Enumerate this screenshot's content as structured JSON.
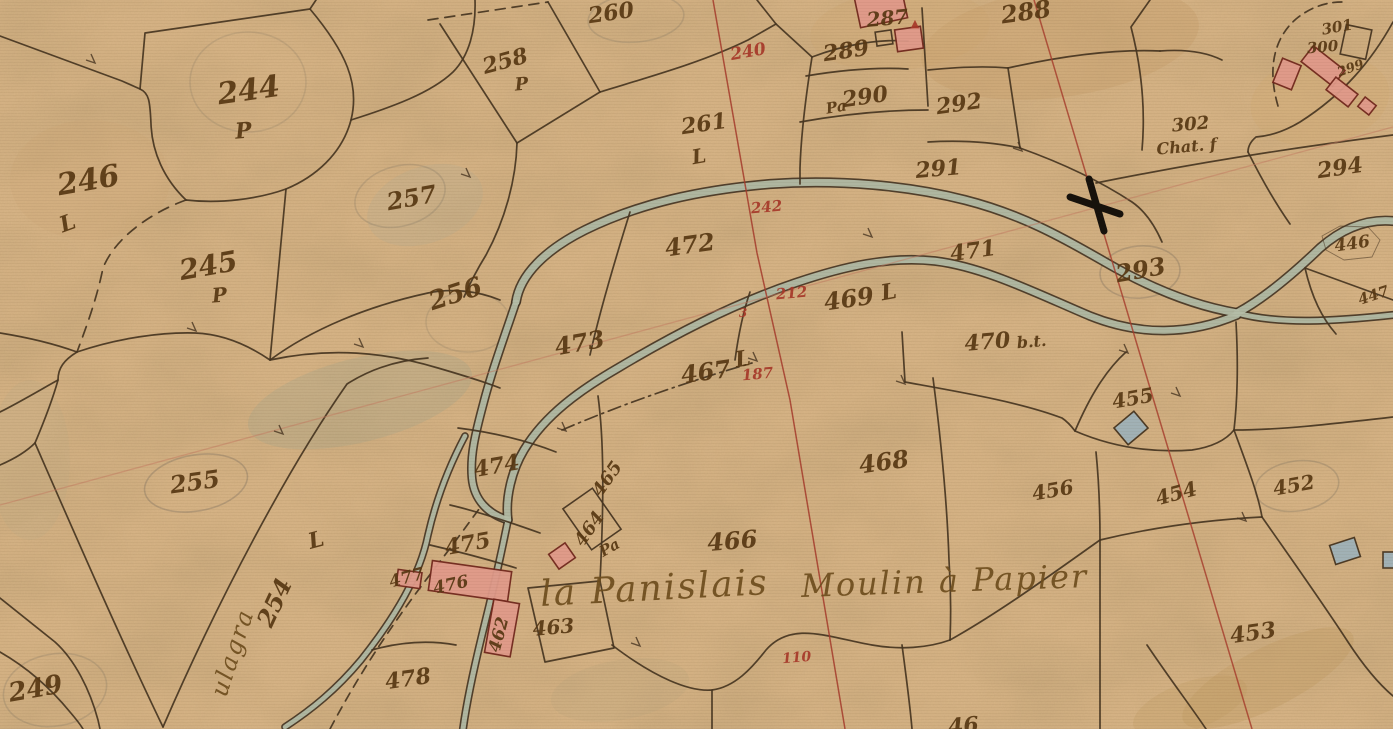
{
  "map": {
    "kind": "cadastral-map-scan",
    "colors": {
      "paper": "#d6b385",
      "ink": "#583813",
      "red": "#a8392a",
      "title": "#6f4e1e",
      "line": "#473521",
      "water": "#b4bda6",
      "bank": "#3f3020",
      "hab_fill": "#e09a8a",
      "hab_stroke": "#73291e",
      "ann_fill": "#9fb2b8",
      "pencil": "#6f675a"
    },
    "labels": [
      {
        "t": "244",
        "x": 250,
        "y": 100,
        "r": -8,
        "s": 30
      },
      {
        "t": "P",
        "x": 244,
        "y": 138,
        "r": -5,
        "s": 22
      },
      {
        "t": "246",
        "x": 90,
        "y": 190,
        "r": -10,
        "s": 30
      },
      {
        "t": "L",
        "x": 70,
        "y": 230,
        "r": -20,
        "s": 22
      },
      {
        "t": "245",
        "x": 210,
        "y": 275,
        "r": -10,
        "s": 28
      },
      {
        "t": "P",
        "x": 220,
        "y": 302,
        "r": -5,
        "s": 20
      },
      {
        "t": "257",
        "x": 413,
        "y": 206,
        "r": -10,
        "s": 24
      },
      {
        "t": "256",
        "x": 458,
        "y": 302,
        "r": -18,
        "s": 26
      },
      {
        "t": "258",
        "x": 507,
        "y": 68,
        "r": -15,
        "s": 22
      },
      {
        "t": "P",
        "x": 522,
        "y": 90,
        "r": -5,
        "s": 18
      },
      {
        "t": "260",
        "x": 612,
        "y": 20,
        "r": -8,
        "s": 22
      },
      {
        "t": "261",
        "x": 705,
        "y": 131,
        "r": -8,
        "s": 22
      },
      {
        "t": "L",
        "x": 700,
        "y": 163,
        "r": -10,
        "s": 20
      },
      {
        "t": "255",
        "x": 196,
        "y": 490,
        "r": -8,
        "s": 24
      },
      {
        "t": "254",
        "x": 282,
        "y": 606,
        "r": -65,
        "s": 24
      },
      {
        "t": "L",
        "x": 318,
        "y": 547,
        "r": -15,
        "s": 22
      },
      {
        "t": "249",
        "x": 37,
        "y": 697,
        "r": -10,
        "s": 26
      },
      {
        "t": "473",
        "x": 581,
        "y": 351,
        "r": -10,
        "s": 24
      },
      {
        "t": "472",
        "x": 691,
        "y": 253,
        "r": -8,
        "s": 24
      },
      {
        "t": "471",
        "x": 974,
        "y": 258,
        "r": -8,
        "s": 22
      },
      {
        "t": "469",
        "x": 850,
        "y": 307,
        "r": -8,
        "s": 24
      },
      {
        "t": "L",
        "x": 890,
        "y": 299,
        "r": -10,
        "s": 22
      },
      {
        "t": "467",
        "x": 707,
        "y": 380,
        "r": -8,
        "s": 24
      },
      {
        "t": "L",
        "x": 744,
        "y": 366,
        "r": -10,
        "s": 22
      },
      {
        "t": "470",
        "x": 988,
        "y": 349,
        "r": -5,
        "s": 22
      },
      {
        "t": "b.t.",
        "x": 1032,
        "y": 347,
        "r": -5,
        "s": 16
      },
      {
        "t": "468",
        "x": 885,
        "y": 470,
        "r": -8,
        "s": 24
      },
      {
        "t": "466",
        "x": 733,
        "y": 549,
        "r": -5,
        "s": 24
      },
      {
        "t": "474",
        "x": 498,
        "y": 473,
        "r": -10,
        "s": 22
      },
      {
        "t": "475",
        "x": 469,
        "y": 551,
        "r": -10,
        "s": 22
      },
      {
        "t": "477",
        "x": 408,
        "y": 583,
        "r": -15,
        "s": 17
      },
      {
        "t": "476",
        "x": 452,
        "y": 590,
        "r": -12,
        "s": 17
      },
      {
        "t": "465",
        "x": 612,
        "y": 482,
        "r": -55,
        "s": 18
      },
      {
        "t": "464",
        "x": 594,
        "y": 532,
        "r": -55,
        "s": 18
      },
      {
        "t": "Pa",
        "x": 612,
        "y": 552,
        "r": -30,
        "s": 15
      },
      {
        "t": "462",
        "x": 504,
        "y": 636,
        "r": -75,
        "s": 17
      },
      {
        "t": "463",
        "x": 554,
        "y": 634,
        "r": -5,
        "s": 20
      },
      {
        "t": "478",
        "x": 409,
        "y": 686,
        "r": -8,
        "s": 22
      },
      {
        "t": "288",
        "x": 1027,
        "y": 20,
        "r": -8,
        "s": 24
      },
      {
        "t": "287",
        "x": 888,
        "y": 25,
        "r": -5,
        "s": 20
      },
      {
        "t": "▲",
        "x": 915,
        "y": 27,
        "r": 0,
        "s": 11,
        "c": "red"
      },
      {
        "t": "289",
        "x": 847,
        "y": 58,
        "r": -8,
        "s": 22
      },
      {
        "t": "Pa",
        "x": 837,
        "y": 112,
        "r": -10,
        "s": 15
      },
      {
        "t": "290",
        "x": 866,
        "y": 104,
        "r": -8,
        "s": 22
      },
      {
        "t": "292",
        "x": 960,
        "y": 111,
        "r": -8,
        "s": 22
      },
      {
        "t": "291",
        "x": 939,
        "y": 176,
        "r": -5,
        "s": 22
      },
      {
        "t": "302",
        "x": 1191,
        "y": 130,
        "r": -5,
        "s": 18
      },
      {
        "t": "Chat. f",
        "x": 1187,
        "y": 152,
        "r": -5,
        "s": 16
      },
      {
        "t": "294",
        "x": 1341,
        "y": 175,
        "r": -8,
        "s": 22
      },
      {
        "t": "301",
        "x": 1338,
        "y": 32,
        "r": -10,
        "s": 15
      },
      {
        "t": "300",
        "x": 1323,
        "y": 52,
        "r": -5,
        "s": 15
      },
      {
        "t": "299",
        "x": 1352,
        "y": 72,
        "r": -20,
        "s": 13
      },
      {
        "t": "293",
        "x": 1142,
        "y": 278,
        "r": -10,
        "s": 24
      },
      {
        "t": "446",
        "x": 1353,
        "y": 249,
        "r": -8,
        "s": 17
      },
      {
        "t": "447",
        "x": 1375,
        "y": 300,
        "r": -18,
        "s": 15
      },
      {
        "t": "455",
        "x": 1134,
        "y": 405,
        "r": -10,
        "s": 20
      },
      {
        "t": "456",
        "x": 1054,
        "y": 497,
        "r": -10,
        "s": 20
      },
      {
        "t": "454",
        "x": 1178,
        "y": 500,
        "r": -15,
        "s": 20
      },
      {
        "t": "452",
        "x": 1295,
        "y": 492,
        "r": -10,
        "s": 20
      },
      {
        "t": "453",
        "x": 1254,
        "y": 640,
        "r": -8,
        "s": 22
      },
      {
        "t": "46",
        "x": 964,
        "y": 733,
        "r": -5,
        "s": 22
      },
      {
        "t": "240",
        "x": 749,
        "y": 57,
        "r": -10,
        "s": 17,
        "c": "red"
      },
      {
        "t": "242",
        "x": 767,
        "y": 212,
        "r": -5,
        "s": 15,
        "c": "red"
      },
      {
        "t": "212",
        "x": 792,
        "y": 298,
        "r": -5,
        "s": 15,
        "c": "red"
      },
      {
        "t": "3",
        "x": 743,
        "y": 317,
        "r": 0,
        "s": 12,
        "c": "red"
      },
      {
        "t": "187",
        "x": 758,
        "y": 379,
        "r": -5,
        "s": 15,
        "c": "red"
      },
      {
        "t": "110",
        "x": 797,
        "y": 662,
        "r": -5,
        "s": 14,
        "c": "red"
      },
      {
        "t": "la Panislais",
        "x": 655,
        "y": 600,
        "r": -3,
        "s": 36,
        "c": "title"
      },
      {
        "t": "Moulin à Papier",
        "x": 945,
        "y": 592,
        "r": -2,
        "s": 32,
        "c": "title"
      },
      {
        "t": "ulagra",
        "x": 240,
        "y": 655,
        "r": -72,
        "s": 24,
        "c": "title"
      }
    ],
    "river": {
      "channels": [
        {
          "d": "M516,302 C520,275 545,250 585,230 C640,203 700,190 770,184 C840,179 910,186 965,200 C1020,214 1060,236 1105,262 C1150,288 1195,306 1237,313",
          "w": 7
        },
        {
          "d": "M508,520 C505,498 512,470 524,450 C545,415 580,390 618,368 C670,337 730,305 795,283 C845,266 890,256 935,261 C985,267 1040,295 1090,316 C1140,336 1190,335 1237,315",
          "w": 6.5
        },
        {
          "d": "M1237,313 C1265,298 1295,272 1320,248 C1345,226 1370,219 1393,221",
          "w": 7
        },
        {
          "d": "M1237,313 C1280,325 1336,321 1393,315",
          "w": 5
        },
        {
          "d": "M516,302 C505,335 492,370 483,405 C475,435 470,456 472,478 C474,500 488,514 508,520",
          "w": 6
        },
        {
          "d": "M508,520 C501,555 492,595 482,635 C474,668 467,700 463,729",
          "w": 5
        },
        {
          "d": "M465,436 C448,468 436,500 428,535 C420,575 396,616 361,660 C336,690 311,710 285,727",
          "w": 4.5
        }
      ]
    },
    "boundaries": [
      {
        "d": "M0,36 L122,81 L140,89"
      },
      {
        "d": "M140,89 L145,33 L310,9 L316,0"
      },
      {
        "d": "M310,9 C346,52 360,84 351,120 C342,154 315,177 286,189 C258,199 220,204 186,200"
      },
      {
        "d": "M186,200 C164,179 152,152 151,124 C150,101 149,93 140,89"
      },
      {
        "d": "M351,120 C392,107 431,93 453,72 C469,56 476,30 475,0"
      },
      {
        "d": "M286,189 C281,248 275,306 270,360"
      },
      {
        "d": "M270,360 C312,329 368,306 428,293 C452,288 478,291 500,300"
      },
      {
        "d": "M0,333 C25,337 52,343 77,352"
      },
      {
        "d": "M77,352 C118,338 162,332 195,333 C223,334 248,345 270,360"
      },
      {
        "d": "M77,352 C64,360 58,368 58,380 C52,402 43,424 35,443"
      },
      {
        "d": "M0,412 C20,402 40,390 58,380"
      },
      {
        "d": "M35,443 C70,523 120,638 163,727"
      },
      {
        "d": "M163,727 C218,600 288,468 347,384 C372,368 400,360 428,358"
      },
      {
        "d": "M0,465 C14,459 26,452 35,443"
      },
      {
        "d": "M0,598 L55,642 C75,660 90,690 98,720 L100,729"
      },
      {
        "d": "M0,652 C28,668 52,690 70,712 C76,719 80,724 83,729"
      },
      {
        "d": "M270,360 C330,347 385,352 438,368 C462,375 482,381 500,388"
      },
      {
        "d": "M428,20 L548,2",
        "dash": "10 7"
      },
      {
        "d": "M548,2 L600,92"
      },
      {
        "d": "M600,92 L517,143"
      },
      {
        "d": "M517,143 L440,24"
      },
      {
        "d": "M517,143 C516,180 505,220 486,255 C478,268 470,283 464,297"
      },
      {
        "d": "M600,92 C652,76 703,62 748,40 L776,24"
      },
      {
        "d": "M757,0 L776,24"
      },
      {
        "d": "M776,24 L812,57 C806,95 801,135 800,168 L800,184"
      },
      {
        "d": "M812,57 C846,44 880,39 908,41"
      },
      {
        "d": "M806,76 C842,70 876,67 908,69"
      },
      {
        "d": "M922,8 L928,106"
      },
      {
        "d": "M800,122 C845,114 890,110 928,110"
      },
      {
        "d": "M928,70 C958,67 986,66 1008,68"
      },
      {
        "d": "M1008,68 C1062,56 1115,49 1160,51"
      },
      {
        "d": "M1008,68 L1020,148"
      },
      {
        "d": "M928,142 C962,140 992,142 1020,148"
      },
      {
        "d": "M1020,148 C1062,163 1100,181 1132,202 C1145,211 1155,226 1162,242"
      },
      {
        "d": "M1160,51 C1186,49 1206,52 1222,60"
      },
      {
        "d": "M1150,0 L1131,27 C1140,62 1146,105 1142,150"
      },
      {
        "d": "M1096,183 C1190,164 1290,148 1393,135"
      },
      {
        "d": "M1393,22 C1372,60 1344,94 1300,122 C1285,131 1270,136 1256,137 C1250,142 1248,147 1248,152"
      },
      {
        "d": "M1248,152 C1262,180 1276,204 1290,224"
      },
      {
        "d": "M1278,106 C1268,72 1272,40 1296,19 C1312,6 1328,2 1342,2",
        "dash": "9 6"
      },
      {
        "d": "M630,212 C615,260 600,310 590,355"
      },
      {
        "d": "M750,292 C742,315 738,338 735,360"
      },
      {
        "d": "M562,430 C625,403 690,381 752,363",
        "dash": "13 5 2 5"
      },
      {
        "d": "M933,378 C941,440 947,500 949,560 C951,590 951,616 950,640"
      },
      {
        "d": "M902,332 C903,350 904,366 905,382"
      },
      {
        "d": "M905,382 C960,392 1020,402 1062,418 C1068,422 1072,427 1075,431"
      },
      {
        "d": "M1075,431 C1090,396 1106,370 1126,352"
      },
      {
        "d": "M1075,431 C1112,447 1152,453 1192,450 C1212,447 1226,440 1234,430"
      },
      {
        "d": "M1234,430 C1238,395 1238,358 1236,322"
      },
      {
        "d": "M1234,430 C1248,468 1258,494 1262,517"
      },
      {
        "d": "M1100,540 C1150,528 1205,520 1262,517"
      },
      {
        "d": "M1262,517 C1292,560 1322,602 1348,642 C1365,668 1380,685 1393,696"
      },
      {
        "d": "M1096,452 C1099,482 1100,510 1100,540"
      },
      {
        "d": "M1100,540 C1100,604 1100,668 1100,729"
      },
      {
        "d": "M950,640 C1000,612 1052,574 1100,540"
      },
      {
        "d": "M612,645 C655,678 690,692 712,690 C735,687 752,668 766,650 C792,620 830,638 872,645 C900,650 928,648 950,640"
      },
      {
        "d": "M712,690 L712,729"
      },
      {
        "d": "M902,645 C906,675 910,705 912,729"
      },
      {
        "d": "M528,588 L600,581 L614,648 L545,662 Z"
      },
      {
        "d": "M372,650 C400,642 428,640 456,645"
      },
      {
        "d": "M598,396 C604,440 604,500 600,581"
      },
      {
        "d": "M450,505 C480,512 512,523 540,533"
      },
      {
        "d": "M430,545 C460,552 490,560 516,568"
      },
      {
        "d": "M1305,268 L1393,300"
      },
      {
        "d": "M1305,268 C1312,298 1322,318 1336,334"
      },
      {
        "d": "M1234,430 C1280,430 1332,424 1393,417"
      },
      {
        "d": "M1147,645 C1172,682 1192,708 1206,729"
      },
      {
        "d": "M186,200 C150,213 115,238 103,268 C97,298 86,328 77,352",
        "dash": "11 8"
      },
      {
        "d": "M330,729 C360,672 395,620 432,572 C452,546 468,524 482,505",
        "dash": "9 7"
      },
      {
        "d": "M458,428 C490,432 525,440 556,452"
      },
      {
        "d": "M1322,236 L1340,226 L1368,227 L1380,240 L1372,257 L1344,260 L1326,250 Z",
        "w": 0.9,
        "op": 0.55
      }
    ],
    "survey_lines": [
      {
        "d": "M713,0 L757,253 L790,400 L845,729",
        "color": "#a63b2b",
        "w": 1.5,
        "op": 0.85
      },
      {
        "d": "M0,505 L1393,127",
        "color": "#c47a60",
        "w": 1.3,
        "op": 0.5
      },
      {
        "d": "M1034,0 L1252,729",
        "color": "#a63b2b",
        "w": 1.5,
        "op": 0.8
      }
    ],
    "benchmark_cross": {
      "x": 1095,
      "y": 205
    },
    "buildings": [
      [
        881,
        8,
        48,
        30,
        -12,
        "hab"
      ],
      [
        909,
        39,
        26,
        22,
        -8,
        "hab"
      ],
      [
        884,
        38,
        16,
        14,
        -8,
        "out"
      ],
      [
        1287,
        74,
        20,
        26,
        22,
        "hab"
      ],
      [
        1323,
        66,
        40,
        20,
        38,
        "hab"
      ],
      [
        1342,
        92,
        28,
        16,
        38,
        "hab"
      ],
      [
        1356,
        42,
        26,
        30,
        12,
        "out"
      ],
      [
        1367,
        106,
        14,
        12,
        38,
        "hab"
      ],
      [
        470,
        581,
        80,
        30,
        8,
        "hab"
      ],
      [
        409,
        579,
        24,
        16,
        8,
        "hab"
      ],
      [
        502,
        628,
        26,
        54,
        10,
        "hab"
      ],
      [
        562,
        556,
        20,
        18,
        -35,
        "hab"
      ],
      [
        592,
        519,
        36,
        50,
        -35,
        "out"
      ],
      [
        1131,
        428,
        26,
        22,
        -40,
        "ann"
      ],
      [
        1345,
        551,
        26,
        20,
        -18,
        "ann"
      ],
      [
        1389,
        560,
        12,
        16,
        0,
        "ann"
      ]
    ],
    "pencil_marks": [
      [
        196,
        483,
        52,
        28,
        -10,
        0.32
      ],
      [
        1140,
        272,
        40,
        26,
        -5,
        0.3
      ],
      [
        248,
        82,
        58,
        50,
        0,
        0.18
      ],
      [
        400,
        196,
        46,
        30,
        -15,
        0.22
      ],
      [
        468,
        322,
        42,
        30,
        0,
        0.18
      ],
      [
        636,
        18,
        48,
        24,
        -5,
        0.22
      ],
      [
        1297,
        486,
        42,
        25,
        -8,
        0.28
      ],
      [
        55,
        690,
        52,
        36,
        -10,
        0.22
      ]
    ],
    "stains": [
      [
        1060,
        42,
        140,
        55,
        -8,
        "#c59c66",
        0.32
      ],
      [
        900,
        30,
        90,
        40,
        -5,
        "#cda771",
        0.28
      ],
      [
        360,
        400,
        115,
        42,
        -14,
        "#9aa28b",
        0.26
      ],
      [
        425,
        205,
        60,
        38,
        -20,
        "#a8a894",
        0.2
      ],
      [
        1268,
        678,
        95,
        30,
        -27,
        "#c09a62",
        0.35
      ],
      [
        1190,
        706,
        60,
        24,
        -20,
        "#c09a62",
        0.28
      ],
      [
        90,
        180,
        80,
        60,
        0,
        "#cda771",
        0.2
      ],
      [
        1320,
        100,
        70,
        45,
        -10,
        "#cfa871",
        0.28
      ],
      [
        30,
        460,
        40,
        80,
        0,
        "#b9a887",
        0.2
      ],
      [
        620,
        690,
        70,
        30,
        -10,
        "#b3a27b",
        0.18
      ]
    ],
    "ticks": [
      [
        196,
        331
      ],
      [
        363,
        347
      ],
      [
        566,
        431
      ],
      [
        757,
        361
      ],
      [
        905,
        384
      ],
      [
        1128,
        353
      ],
      [
        640,
        646
      ],
      [
        1246,
        521
      ],
      [
        470,
        177
      ],
      [
        1022,
        151
      ],
      [
        283,
        434
      ],
      [
        95,
        63
      ],
      [
        872,
        237
      ],
      [
        1180,
        396
      ]
    ]
  }
}
